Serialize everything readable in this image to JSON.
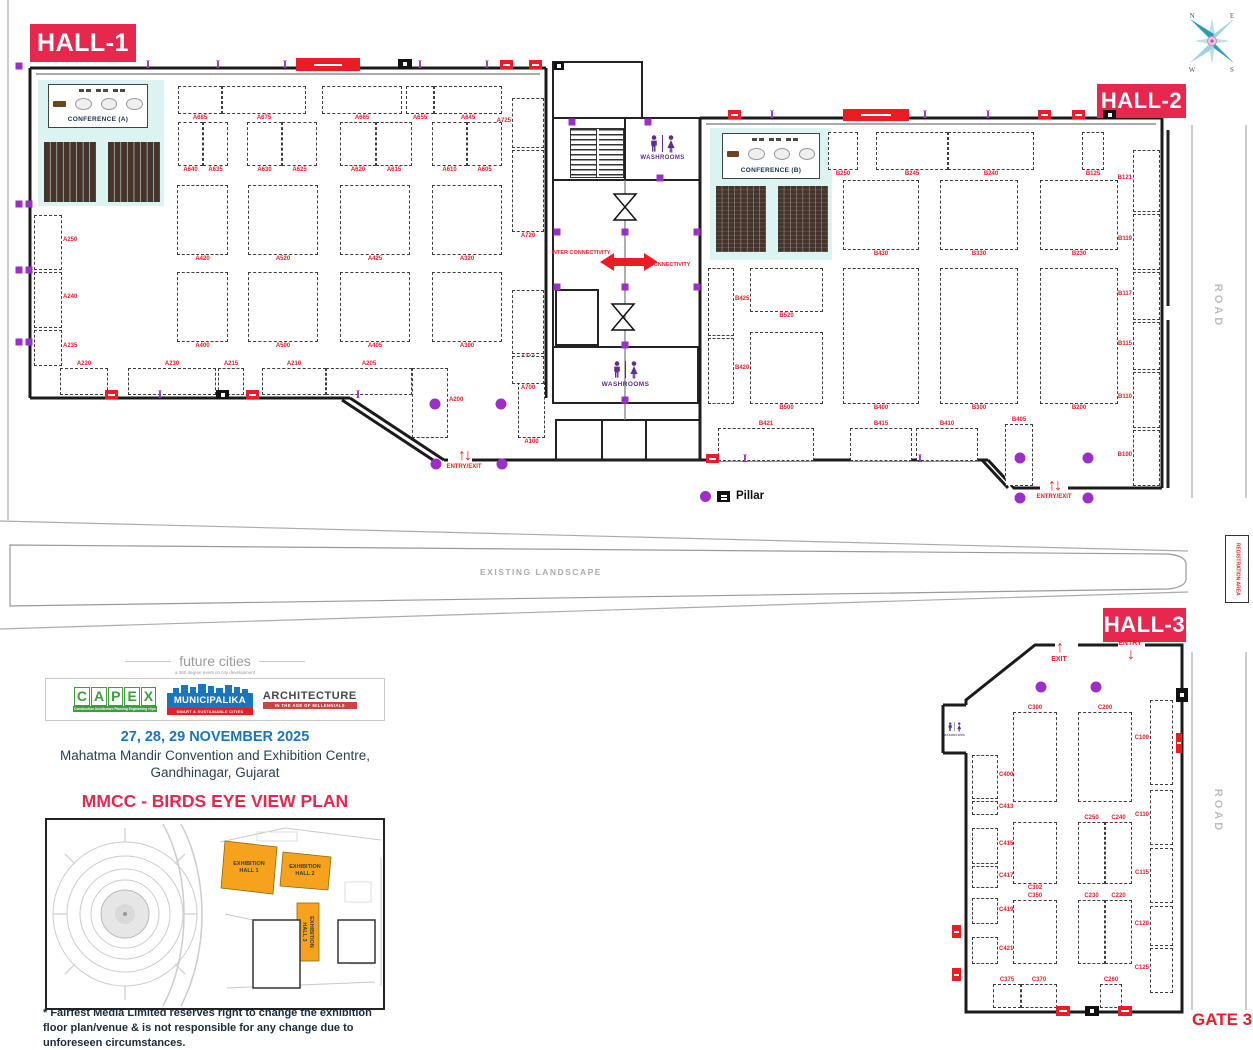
{
  "halls": [
    {
      "label": "HALL-1"
    },
    {
      "label": "HALL-2"
    },
    {
      "label": "HALL-3"
    }
  ],
  "legend": {
    "pillar": "Pillar"
  },
  "labels": {
    "washrooms": "WASHROOMS",
    "conference_a": "CONFERENCE (A)",
    "conference_b": "CONFERENCE (B)",
    "inter_connectivity": "INTER CONNECTIVITY",
    "entry_exit": "ENTRY/EXIT",
    "entry": "ENTRY",
    "exit": "EXIT",
    "existing_landscape": "EXISTING LANDSCAPE",
    "registration_area": "REGISTRATION AREA",
    "road": "ROAD",
    "gate3": "GATE 3"
  },
  "compass": {
    "n": "N",
    "e": "E",
    "s": "S",
    "w": "W"
  },
  "event": {
    "brand_top": "future cities",
    "brand_sub": "a 360 degree event on city development",
    "capex": {
      "letters": [
        "C",
        "A",
        "P",
        "E",
        "X"
      ],
      "tagline": "Construction Architecture Planning Engineering eXpo"
    },
    "municipalika": {
      "name": "MUNICIPALIKA",
      "tagline": "SMART & SUSTAINABLE CITIES"
    },
    "architecture": {
      "name": "ARCHITECTURE",
      "tagline": "IN THE AGE OF MILLENNIALS"
    },
    "dates": "27, 28, 29 NOVEMBER 2025",
    "venue1": "Mahatma Mandir Convention and Exhibition Centre,",
    "venue2": "Gandhinagar, Gujarat"
  },
  "birdseye": {
    "title": "MMCC - BIRDS EYE VIEW PLAN",
    "hall1": "EXHIBITION HALL 1",
    "hall2": "EXHIBITION HALL 2",
    "hall3": "EXHIBITION HALL 3"
  },
  "disclaimer": "* Fairfest Media Limited reserves right to change the exhibition floor plan/venue & is not responsible for any change due to unforeseen circumstances.",
  "colors": {
    "pink": "#E8274F",
    "red": "#EC1C24",
    "purple": "#9B30C9",
    "cyan": "#DCF4F1",
    "seat": "#46342B",
    "blue": "#1B75BC",
    "navy": "#2C3E50",
    "gray": "#BDBDBD",
    "orange": "#F6A21D",
    "green": "#3F9B3F",
    "darkred": "#C9453F"
  },
  "booths": {
    "hall1": [
      {
        "x": 178,
        "y": 86,
        "w": 44,
        "h": 28,
        "label": "A685"
      },
      {
        "x": 222,
        "y": 86,
        "w": 84,
        "h": 28,
        "label": "A675"
      },
      {
        "x": 322,
        "y": 86,
        "w": 80,
        "h": 28,
        "label": "A665"
      },
      {
        "x": 406,
        "y": 86,
        "w": 28,
        "h": 28,
        "label": "A655"
      },
      {
        "x": 434,
        "y": 86,
        "w": 68,
        "h": 28,
        "label": "A645"
      },
      {
        "x": 178,
        "y": 122,
        "w": 25,
        "h": 44,
        "label": "A640"
      },
      {
        "x": 203,
        "y": 122,
        "w": 25,
        "h": 44,
        "label": "A635"
      },
      {
        "x": 247,
        "y": 122,
        "w": 35,
        "h": 44,
        "label": "A630"
      },
      {
        "x": 282,
        "y": 122,
        "w": 35,
        "h": 44,
        "label": "A625"
      },
      {
        "x": 340,
        "y": 122,
        "w": 36,
        "h": 44,
        "label": "A620"
      },
      {
        "x": 376,
        "y": 122,
        "w": 36,
        "h": 44,
        "label": "A615"
      },
      {
        "x": 432,
        "y": 122,
        "w": 35,
        "h": 44,
        "label": "A610"
      },
      {
        "x": 467,
        "y": 122,
        "w": 35,
        "h": 44,
        "label": "A605"
      },
      {
        "x": 177,
        "y": 185,
        "w": 51,
        "h": 70,
        "label": "A420"
      },
      {
        "x": 248,
        "y": 185,
        "w": 70,
        "h": 70,
        "label": "A520"
      },
      {
        "x": 340,
        "y": 185,
        "w": 70,
        "h": 70,
        "label": "A425"
      },
      {
        "x": 432,
        "y": 185,
        "w": 70,
        "h": 70,
        "label": "A320"
      },
      {
        "x": 177,
        "y": 272,
        "w": 51,
        "h": 70,
        "label": "A400"
      },
      {
        "x": 248,
        "y": 272,
        "w": 70,
        "h": 70,
        "label": "A500"
      },
      {
        "x": 340,
        "y": 272,
        "w": 70,
        "h": 70,
        "label": "A405"
      },
      {
        "x": 432,
        "y": 272,
        "w": 70,
        "h": 70,
        "label": "A300"
      },
      {
        "x": 60,
        "y": 368,
        "w": 48,
        "h": 27,
        "label": "A220",
        "lpos": "top"
      },
      {
        "x": 128,
        "y": 368,
        "w": 88,
        "h": 27,
        "label": "A230",
        "lpos": "top"
      },
      {
        "x": 218,
        "y": 368,
        "w": 26,
        "h": 27,
        "label": "A215",
        "lpos": "top"
      },
      {
        "x": 262,
        "y": 368,
        "w": 64,
        "h": 27,
        "label": "A210",
        "lpos": "top"
      },
      {
        "x": 326,
        "y": 368,
        "w": 86,
        "h": 27,
        "label": "A205",
        "lpos": "top"
      },
      {
        "x": 412,
        "y": 368,
        "w": 36,
        "h": 70,
        "label": "A200",
        "side": "right"
      },
      {
        "x": 518,
        "y": 382,
        "w": 27,
        "h": 56,
        "label": "A100"
      },
      {
        "x": 34,
        "y": 215,
        "w": 28,
        "h": 55,
        "label": "A250",
        "side": "right"
      },
      {
        "x": 34,
        "y": 272,
        "w": 28,
        "h": 56,
        "label": "A240",
        "side": "right"
      },
      {
        "x": 34,
        "y": 330,
        "w": 28,
        "h": 36,
        "label": "A235",
        "side": "right"
      },
      {
        "x": 512,
        "y": 98,
        "w": 32,
        "h": 50,
        "label": "A725",
        "side": "left"
      },
      {
        "x": 512,
        "y": 150,
        "w": 32,
        "h": 82,
        "label": "A720"
      },
      {
        "x": 512,
        "y": 290,
        "w": 32,
        "h": 64,
        "label": "A710"
      },
      {
        "x": 512,
        "y": 356,
        "w": 32,
        "h": 28,
        "label": "A700"
      }
    ],
    "hall2": [
      {
        "x": 828,
        "y": 132,
        "w": 30,
        "h": 38,
        "label": "B250"
      },
      {
        "x": 876,
        "y": 132,
        "w": 72,
        "h": 38,
        "label": "B245"
      },
      {
        "x": 948,
        "y": 132,
        "w": 86,
        "h": 38,
        "label": "B240"
      },
      {
        "x": 1082,
        "y": 132,
        "w": 22,
        "h": 38,
        "label": "B125"
      },
      {
        "x": 843,
        "y": 180,
        "w": 76,
        "h": 70,
        "label": "B430"
      },
      {
        "x": 940,
        "y": 180,
        "w": 78,
        "h": 70,
        "label": "B330"
      },
      {
        "x": 1040,
        "y": 180,
        "w": 78,
        "h": 70,
        "label": "B230"
      },
      {
        "x": 708,
        "y": 268,
        "w": 26,
        "h": 68,
        "label": "B425",
        "side": "right"
      },
      {
        "x": 708,
        "y": 338,
        "w": 26,
        "h": 66,
        "label": "B420",
        "side": "right"
      },
      {
        "x": 750,
        "y": 268,
        "w": 73,
        "h": 44,
        "label": "B520"
      },
      {
        "x": 750,
        "y": 332,
        "w": 73,
        "h": 72,
        "label": "B500"
      },
      {
        "x": 843,
        "y": 268,
        "w": 76,
        "h": 136,
        "label": "B400"
      },
      {
        "x": 940,
        "y": 268,
        "w": 78,
        "h": 136,
        "label": "B300"
      },
      {
        "x": 1040,
        "y": 268,
        "w": 78,
        "h": 136,
        "label": "B200"
      },
      {
        "x": 718,
        "y": 428,
        "w": 96,
        "h": 33,
        "label": "B421",
        "lpos": "top"
      },
      {
        "x": 850,
        "y": 428,
        "w": 62,
        "h": 33,
        "label": "B415",
        "lpos": "top"
      },
      {
        "x": 916,
        "y": 428,
        "w": 62,
        "h": 33,
        "label": "B410",
        "lpos": "top"
      },
      {
        "x": 1005,
        "y": 424,
        "w": 28,
        "h": 62,
        "label": "B405",
        "lpos": "top"
      },
      {
        "x": 1133,
        "y": 150,
        "w": 27,
        "h": 62,
        "label": "B121",
        "side": "left"
      },
      {
        "x": 1133,
        "y": 214,
        "w": 27,
        "h": 56,
        "label": "B119",
        "side": "left"
      },
      {
        "x": 1133,
        "y": 272,
        "w": 27,
        "h": 48,
        "label": "B117",
        "side": "left"
      },
      {
        "x": 1133,
        "y": 322,
        "w": 27,
        "h": 48,
        "label": "B115",
        "side": "left"
      },
      {
        "x": 1133,
        "y": 372,
        "w": 27,
        "h": 56,
        "label": "B110",
        "side": "left"
      },
      {
        "x": 1133,
        "y": 430,
        "w": 27,
        "h": 56,
        "label": "B100",
        "side": "left"
      }
    ],
    "hall3": [
      {
        "x": 1013,
        "y": 712,
        "w": 44,
        "h": 90,
        "label": "C300",
        "lpos": "top"
      },
      {
        "x": 1078,
        "y": 712,
        "w": 54,
        "h": 90,
        "label": "C200",
        "lpos": "top"
      },
      {
        "x": 1013,
        "y": 822,
        "w": 44,
        "h": 62,
        "label": "C302"
      },
      {
        "x": 1078,
        "y": 822,
        "w": 27,
        "h": 62,
        "label": "C250",
        "lpos": "top"
      },
      {
        "x": 1105,
        "y": 822,
        "w": 27,
        "h": 62,
        "label": "C240",
        "lpos": "top"
      },
      {
        "x": 1013,
        "y": 900,
        "w": 44,
        "h": 64,
        "label": "C350",
        "lpos": "top"
      },
      {
        "x": 1078,
        "y": 900,
        "w": 27,
        "h": 64,
        "label": "C230",
        "lpos": "top"
      },
      {
        "x": 1105,
        "y": 900,
        "w": 27,
        "h": 64,
        "label": "C220",
        "lpos": "top"
      },
      {
        "x": 993,
        "y": 984,
        "w": 28,
        "h": 24,
        "label": "C375",
        "lpos": "top"
      },
      {
        "x": 1021,
        "y": 984,
        "w": 36,
        "h": 24,
        "label": "C370",
        "lpos": "top"
      },
      {
        "x": 1100,
        "y": 984,
        "w": 22,
        "h": 24,
        "label": "C260",
        "lpos": "top"
      },
      {
        "x": 1150,
        "y": 700,
        "w": 23,
        "h": 85,
        "label": "C100",
        "side": "left"
      },
      {
        "x": 1150,
        "y": 790,
        "w": 23,
        "h": 55,
        "label": "C110",
        "side": "left"
      },
      {
        "x": 1150,
        "y": 848,
        "w": 23,
        "h": 55,
        "label": "C115",
        "side": "left"
      },
      {
        "x": 1150,
        "y": 906,
        "w": 23,
        "h": 40,
        "label": "C120",
        "side": "left"
      },
      {
        "x": 1150,
        "y": 948,
        "w": 23,
        "h": 45,
        "label": "C125",
        "side": "left"
      },
      {
        "x": 972,
        "y": 755,
        "w": 26,
        "h": 44,
        "label": "C400",
        "side": "right"
      },
      {
        "x": 972,
        "y": 801,
        "w": 26,
        "h": 14,
        "label": "C413",
        "side": "right"
      },
      {
        "x": 972,
        "y": 828,
        "w": 26,
        "h": 36,
        "label": "C415",
        "side": "right"
      },
      {
        "x": 972,
        "y": 866,
        "w": 26,
        "h": 22,
        "label": "C417",
        "side": "right"
      },
      {
        "x": 972,
        "y": 898,
        "w": 26,
        "h": 26,
        "label": "C419",
        "side": "right"
      },
      {
        "x": 972,
        "y": 937,
        "w": 26,
        "h": 27,
        "label": "C421",
        "side": "right"
      }
    ]
  },
  "pillars": {
    "circles": [
      [
        435,
        404
      ],
      [
        501,
        404
      ],
      [
        436,
        464
      ],
      [
        502,
        464
      ],
      [
        1020,
        458
      ],
      [
        1088,
        458
      ],
      [
        1020,
        498
      ],
      [
        1088,
        498
      ],
      [
        1041,
        687
      ],
      [
        1096,
        687
      ]
    ],
    "squares": [
      [
        19,
        66
      ],
      [
        19,
        204
      ],
      [
        29,
        204
      ],
      [
        19,
        270
      ],
      [
        29,
        270
      ],
      [
        19,
        342
      ],
      [
        29,
        342
      ],
      [
        557,
        232
      ],
      [
        625,
        232
      ],
      [
        697,
        232
      ],
      [
        557,
        287
      ],
      [
        625,
        287
      ],
      [
        697,
        287
      ],
      [
        625,
        345
      ],
      [
        625,
        400
      ],
      [
        572,
        122
      ],
      [
        648,
        122
      ],
      [
        660,
        178
      ]
    ],
    "ibeams": [
      [
        148,
        64
      ],
      [
        218,
        64
      ],
      [
        285,
        64
      ],
      [
        420,
        64
      ],
      [
        487,
        64
      ],
      [
        160,
        394
      ],
      [
        358,
        394
      ],
      [
        772,
        114
      ],
      [
        925,
        114
      ],
      [
        988,
        114
      ],
      [
        745,
        458
      ],
      [
        920,
        458
      ]
    ]
  },
  "wall_marks": {
    "banners": [
      [
        296,
        58,
        64,
        13
      ],
      [
        843,
        109,
        66,
        12
      ]
    ],
    "red": [
      [
        500,
        60,
        13,
        9
      ],
      [
        529,
        60,
        13,
        9
      ],
      [
        105,
        390,
        13,
        9
      ],
      [
        246,
        390,
        13,
        9
      ],
      [
        728,
        110,
        13,
        9
      ],
      [
        1038,
        110,
        13,
        9
      ],
      [
        1072,
        110,
        13,
        9
      ],
      [
        706,
        454,
        13,
        9
      ],
      [
        1056,
        1006,
        14,
        10
      ],
      [
        1118,
        1006,
        14,
        10
      ],
      [
        952,
        925,
        9,
        13
      ],
      [
        952,
        968,
        9,
        13
      ],
      [
        1176,
        733,
        6,
        20
      ]
    ],
    "black": [
      [
        398,
        59,
        14,
        10
      ],
      [
        216,
        390,
        13,
        9
      ],
      [
        1103,
        110,
        13,
        9
      ],
      [
        1085,
        1006,
        14,
        10
      ],
      [
        1176,
        688,
        12,
        14
      ],
      [
        554,
        62,
        10,
        8
      ]
    ]
  }
}
